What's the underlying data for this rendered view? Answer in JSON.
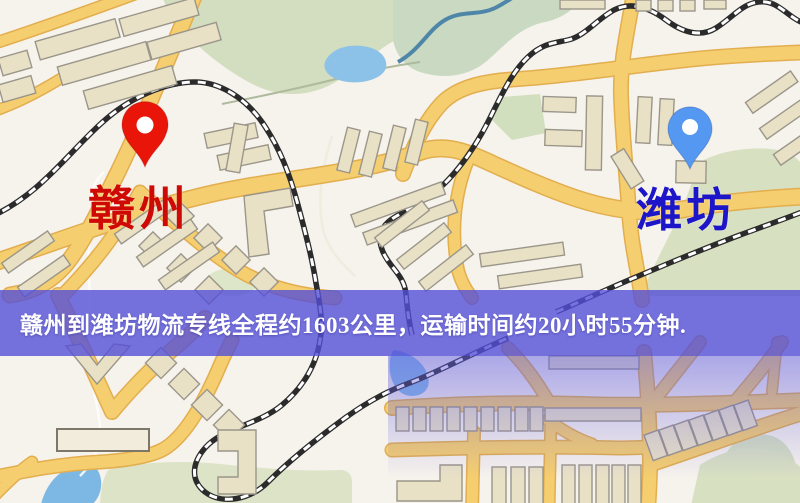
{
  "banner": {
    "text": "赣州到潍坊物流专线全程约1603公里，运输时间约20小时55分钟.",
    "distance_text": "约1603公里",
    "duration_text": "约20小时55分钟",
    "background_color": "#544fd8",
    "text_color": "#ffffff"
  },
  "map": {
    "origin": {
      "label": "赣州",
      "pin_color": "#ea1509",
      "label_color": "#cf0a04"
    },
    "destination": {
      "label": "潍坊",
      "pin_color": "#5598f2",
      "label_color": "#1c16c8"
    },
    "icons": {
      "origin_pin": "red-map-pin-icon",
      "destination_pin": "blue-map-pin-icon"
    },
    "palette": {
      "background": "#f6f2ec",
      "road_fill": "#f5ce70",
      "road_casing": "#e2ae4e",
      "building_fill": "#e9e1c6",
      "building_stroke": "#9b968a",
      "park_green": "#d8e0c2",
      "water_blue": "#8cc2e8",
      "railway_dark": "#2b2b2b"
    }
  }
}
